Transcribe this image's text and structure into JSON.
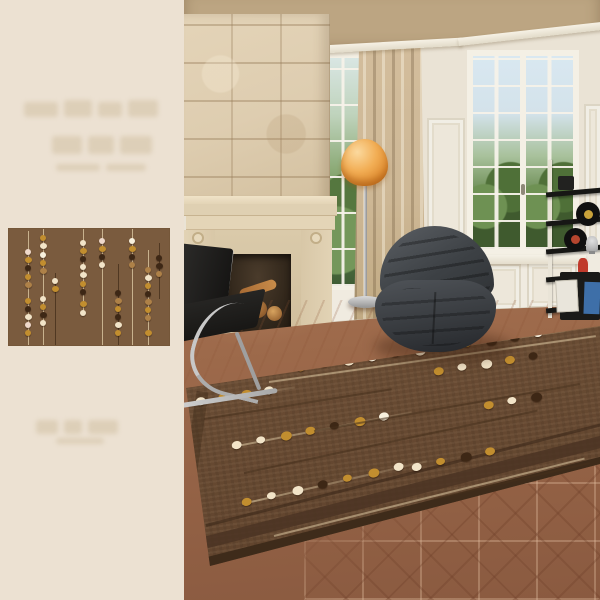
{
  "image_alt": "Living room product photo: brown area rug with beaded dot strands, stone fireplace, dark lounge chair, floor lamp, French windows; small rug swatch inset on cream left panel with faint illegible watermarks",
  "left_panel": {
    "watermark_top_text": "",
    "watermark_bottom_text": ""
  },
  "palette": {
    "panel_bg": "#ECE1D2",
    "wall": "#EAE3D5",
    "wainscot": "#F0EBE0",
    "stone": "#DECDB0",
    "curtain": "#CDB795",
    "rug_base": "#7A5B3E",
    "room_rug_base": "#6F5138",
    "rug_border_band": "#4B3423",
    "dot_cream": "#F2E4C8",
    "dot_gold": "#C28E2F",
    "dot_dark": "#3D2715",
    "dot_tan": "#AE8148",
    "dot_pink": "#EFD9CB",
    "dot_white": "#F8F1DE",
    "line_light": "#DCC8A2",
    "line_dark": "#46301C",
    "window_sky": "#D9E8F1",
    "window_trees": "#57793F",
    "lamp_shade": "#E89A3F",
    "armchair_fabric": "#3E4247",
    "leather_black": "#1E1D1B",
    "chrome": "#C6C6C6",
    "floor_light": "#C48E68",
    "floor_dark": "#8A5A40"
  },
  "rug_pattern": {
    "strands": [
      {
        "x": 12,
        "line": "light",
        "line_from": 2,
        "line_to": 100,
        "dots": [
          [
            20,
            "pink"
          ],
          [
            27,
            "gold"
          ],
          [
            34,
            "dark"
          ],
          [
            41,
            "gold"
          ],
          [
            48,
            "tan"
          ],
          [
            62,
            "gold"
          ],
          [
            69,
            "dark"
          ],
          [
            76,
            "cream"
          ],
          [
            83,
            "pink"
          ],
          [
            90,
            "gold"
          ]
        ]
      },
      {
        "x": 21,
        "line": "light",
        "line_from": 0,
        "line_to": 100,
        "dots": [
          [
            8,
            "gold"
          ],
          [
            15,
            "cream"
          ],
          [
            22,
            "white"
          ],
          [
            29,
            "gold"
          ],
          [
            36,
            "tan"
          ],
          [
            60,
            "cream"
          ],
          [
            67,
            "gold"
          ],
          [
            74,
            "dark"
          ],
          [
            81,
            "cream"
          ]
        ]
      },
      {
        "x": 29,
        "line": "dark",
        "line_from": 38,
        "line_to": 100,
        "dots": [
          [
            45,
            "cream"
          ],
          [
            52,
            "gold"
          ]
        ]
      },
      {
        "x": 46,
        "line": "light",
        "line_from": 0,
        "line_to": 74,
        "dots": [
          [
            12,
            "cream"
          ],
          [
            19,
            "gold"
          ],
          [
            26,
            "dark"
          ],
          [
            33,
            "cream"
          ],
          [
            40,
            "cream"
          ],
          [
            47,
            "gold"
          ],
          [
            54,
            "dark"
          ],
          [
            65,
            "gold"
          ],
          [
            72,
            "cream"
          ]
        ]
      },
      {
        "x": 58,
        "line": "light",
        "line_from": 0,
        "line_to": 100,
        "dots": [
          [
            10,
            "pink"
          ],
          [
            17,
            "gold"
          ],
          [
            24,
            "dark"
          ],
          [
            31,
            "cream"
          ]
        ]
      },
      {
        "x": 68,
        "line": "dark",
        "line_from": 30,
        "line_to": 100,
        "dots": [
          [
            55,
            "dark"
          ],
          [
            62,
            "tan"
          ],
          [
            69,
            "gold"
          ],
          [
            76,
            "dark"
          ],
          [
            83,
            "cream"
          ],
          [
            90,
            "gold"
          ]
        ]
      },
      {
        "x": 77,
        "line": "light",
        "line_from": 0,
        "line_to": 100,
        "dots": [
          [
            10,
            "white"
          ],
          [
            17,
            "gold"
          ],
          [
            24,
            "dark"
          ],
          [
            31,
            "tan"
          ]
        ]
      },
      {
        "x": 87,
        "line": "light",
        "line_from": 18,
        "line_to": 100,
        "dots": [
          [
            35,
            "tan"
          ],
          [
            42,
            "cream"
          ],
          [
            49,
            "gold"
          ],
          [
            56,
            "dark"
          ],
          [
            63,
            "tan"
          ],
          [
            70,
            "gold"
          ],
          [
            77,
            "tan"
          ],
          [
            90,
            "gold"
          ]
        ]
      },
      {
        "x": 94,
        "line": "dark",
        "line_from": 12,
        "line_to": 60,
        "dots": [
          [
            25,
            "dark"
          ],
          [
            32,
            "dark"
          ],
          [
            39,
            "tan"
          ]
        ]
      }
    ]
  },
  "room_rug": {
    "rows": [
      {
        "x": 112,
        "y": 368,
        "angle": -8,
        "gap": 24,
        "line": "light",
        "dots": [
          "gold",
          "gold",
          "cream",
          "white",
          "dark",
          "cream",
          "gold",
          "gold",
          "dark",
          "dark",
          "white"
        ]
      },
      {
        "x": 12,
        "y": 402,
        "angle": -9,
        "gap": 23,
        "line": "light",
        "dots": [
          "cream",
          "gold",
          "gold",
          "cream"
        ]
      },
      {
        "x": 250,
        "y": 372,
        "angle": -9,
        "gap": 24,
        "line": "none",
        "dots": [
          "gold",
          "cream",
          "cream",
          "gold",
          "dark"
        ]
      },
      {
        "x": 48,
        "y": 446,
        "angle": -11,
        "gap": 25,
        "line": "light",
        "dots": [
          "cream",
          "cream",
          "gold",
          "gold",
          "dark",
          "gold",
          "white"
        ]
      },
      {
        "x": 300,
        "y": 406,
        "angle": -10,
        "gap": 24,
        "line": "none",
        "dots": [
          "gold",
          "cream",
          "dark"
        ]
      },
      {
        "x": 58,
        "y": 503,
        "angle": -13,
        "gap": 26,
        "line": "light",
        "dots": [
          "gold",
          "cream",
          "cream",
          "dark",
          "gold",
          "gold",
          "cream"
        ]
      },
      {
        "x": 228,
        "y": 468,
        "angle": -12,
        "gap": 25,
        "line": "none",
        "dots": [
          "cream",
          "gold",
          "dark",
          "gold"
        ]
      }
    ],
    "lines": [
      {
        "x": 85,
        "y": 381,
        "len": 330,
        "angle": -8,
        "tone": "light"
      },
      {
        "x": 20,
        "y": 418,
        "len": 190,
        "angle": -9,
        "tone": "dark"
      },
      {
        "x": 130,
        "y": 430,
        "len": 270,
        "angle": -10,
        "tone": "dark"
      },
      {
        "x": 60,
        "y": 472,
        "len": 300,
        "angle": -12,
        "tone": "dark"
      },
      {
        "x": 90,
        "y": 535,
        "len": 320,
        "angle": -14,
        "tone": "light"
      },
      {
        "x": 250,
        "y": 498,
        "len": 160,
        "angle": -13,
        "tone": "dark"
      }
    ]
  },
  "shelf": {
    "record1_label": "#C9A23A",
    "record2_label": "#B5452E"
  }
}
